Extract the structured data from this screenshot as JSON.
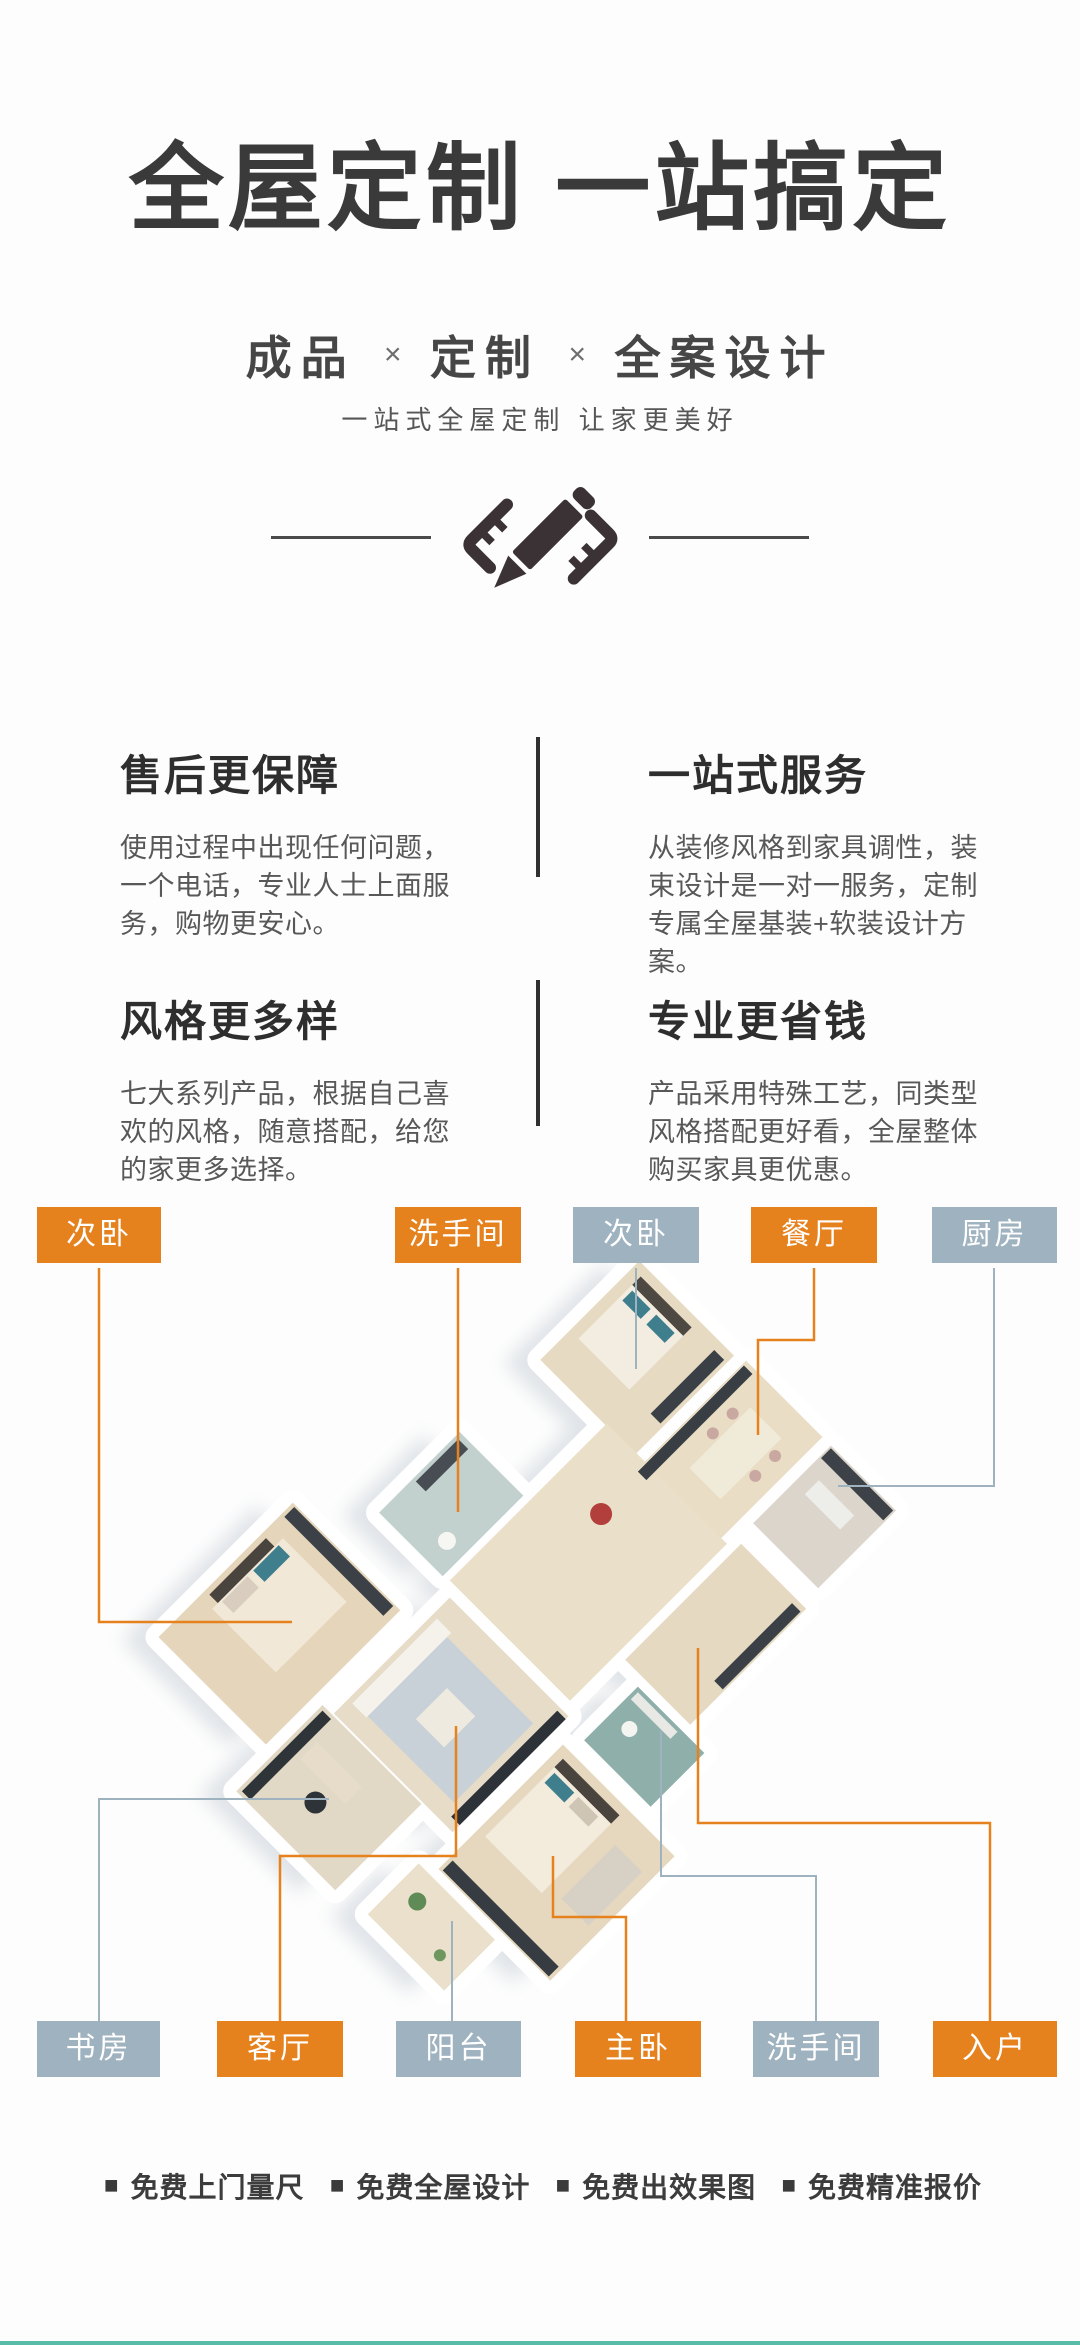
{
  "colors": {
    "orange": "#E5821E",
    "gray_blue": "#9FB2C0",
    "title_ink": "#3A3A3A",
    "icon_dark": "#3B3236",
    "bottom_bar": "#58BCA8"
  },
  "hero": {
    "title": "全屋定制 一站搞定",
    "subtitle_parts": [
      "成品",
      "定制",
      "全案设计"
    ],
    "subtitle_separator": "×",
    "tagline": "一站式全屋定制 让家更美好"
  },
  "features": [
    {
      "title": "售后更保障",
      "body": "使用过程中出现任何问题，一个电话，专业人士上面服务，购物更安心。"
    },
    {
      "title": "一站式服务",
      "body": "从装修风格到家具调性，装束设计是一对一服务，定制专属全屋基装+软装设计方案。"
    },
    {
      "title": "风格更多样",
      "body": "七大系列产品，根据自己喜欢的风格，随意搭配，给您的家更多选择。"
    },
    {
      "title": "专业更省钱",
      "body": "产品采用特殊工艺，同类型风格搭配更好看，全屋整体购买家具更优惠。"
    }
  ],
  "floorplan": {
    "top_labels": [
      {
        "text": "次卧",
        "variant": "orange"
      },
      {
        "text": "洗手间",
        "variant": "orange"
      },
      {
        "text": "次卧",
        "variant": "gray"
      },
      {
        "text": "餐厅",
        "variant": "orange"
      },
      {
        "text": "厨房",
        "variant": "gray"
      }
    ],
    "bottom_labels": [
      {
        "text": "书房",
        "variant": "gray"
      },
      {
        "text": "客厅",
        "variant": "orange"
      },
      {
        "text": "阳台",
        "variant": "gray"
      },
      {
        "text": "主卧",
        "variant": "orange"
      },
      {
        "text": "洗手间",
        "variant": "gray"
      },
      {
        "text": "入户",
        "variant": "orange"
      }
    ]
  },
  "services_bullet": "■",
  "services": [
    {
      "text": "免费上门量尺"
    },
    {
      "text": "免费全屋设计"
    },
    {
      "text": "免费出效果图"
    },
    {
      "text": "免费精准报价"
    }
  ]
}
